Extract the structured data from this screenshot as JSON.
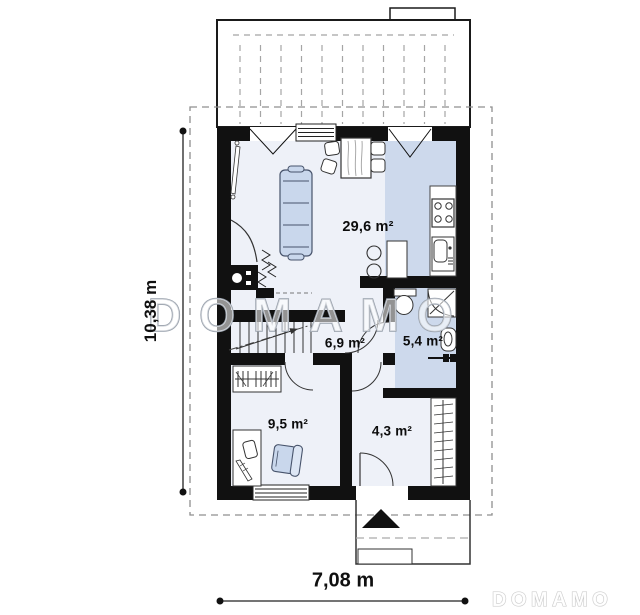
{
  "type": "floor-plan",
  "watermarks": {
    "center": "DOMAMO",
    "corner": "DOMAMO"
  },
  "dimensions": {
    "total_width": "7,08 m",
    "total_height": "10,38 m"
  },
  "rooms": {
    "living_dining_kitchen": {
      "label": "29,6 m²"
    },
    "hallway": {
      "label": "6,9 m²"
    },
    "bathroom": {
      "label": "5,4 m²"
    },
    "room": {
      "label": "9,5 m²"
    },
    "entrance_hall": {
      "label": "4,3 m²"
    }
  },
  "colors": {
    "wall": "#111111",
    "floor_light": "#eef1f8",
    "floor_blue": "#cdd9ec",
    "furniture_blue": "#c9d7ec",
    "dashed_lines": "#999999",
    "watermark_stroke": "#99a1ac"
  }
}
